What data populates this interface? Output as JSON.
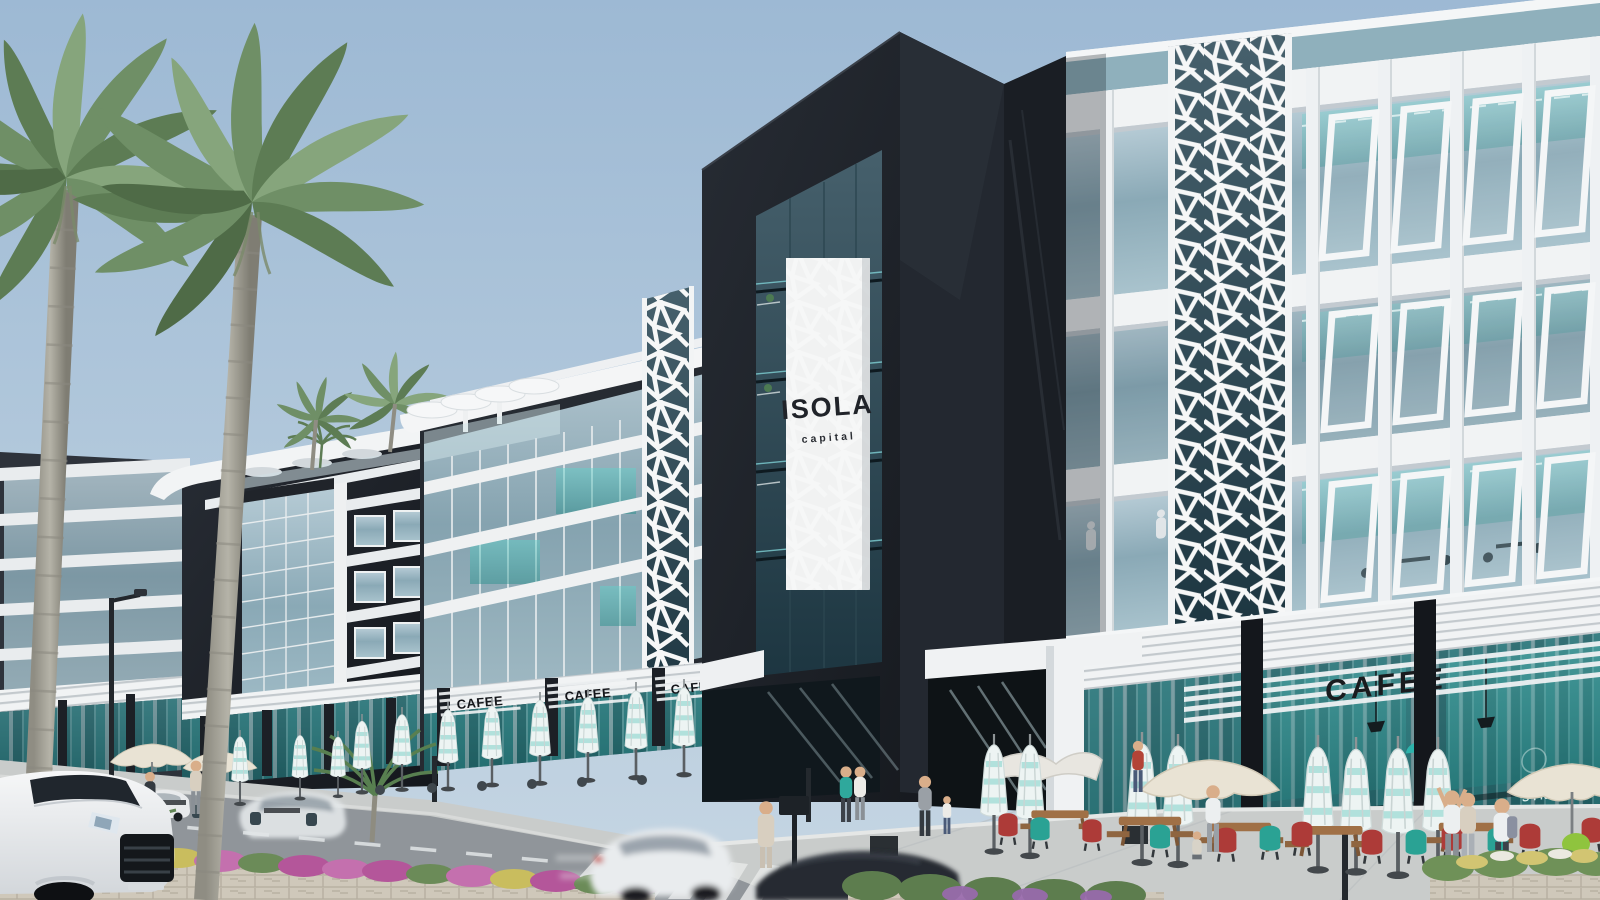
{
  "scene": {
    "description": "Daytime architectural rendering of the ISOLA capital commercial strip: dark and white modern buildings with teal glass, arabesque lattice columns, street-level cafes with folded teal umbrellas, palm trees, flowered median and passing cars."
  },
  "signs": {
    "tower_name": "ISOLA",
    "tower_tagline": "capital",
    "cafe_right": "CAFEE",
    "cafe_mid": [
      "CAFEE",
      "CAFEE",
      "CAFEE"
    ],
    "glass_decal": "STN"
  },
  "palette": {
    "sky_top": "#9db9d4",
    "sky_bottom": "#c6d6e3",
    "dark_facade": "#23272e",
    "white_structure": "#f1f3f4",
    "glass_steel": "#8aa9b6",
    "glass_teal_interior": "#3fc0b8",
    "umbrella_white": "#edf4f3",
    "umbrella_teal": "#aadfd9",
    "chair_red": "#ad3b38",
    "chair_teal": "#2aa294",
    "flower_magenta": "#b4569a",
    "flower_yellow": "#c9bd5e",
    "road_asphalt": "#90959a",
    "stone_beige": "#cfc8ba",
    "palm_green": "#5d7c54"
  }
}
